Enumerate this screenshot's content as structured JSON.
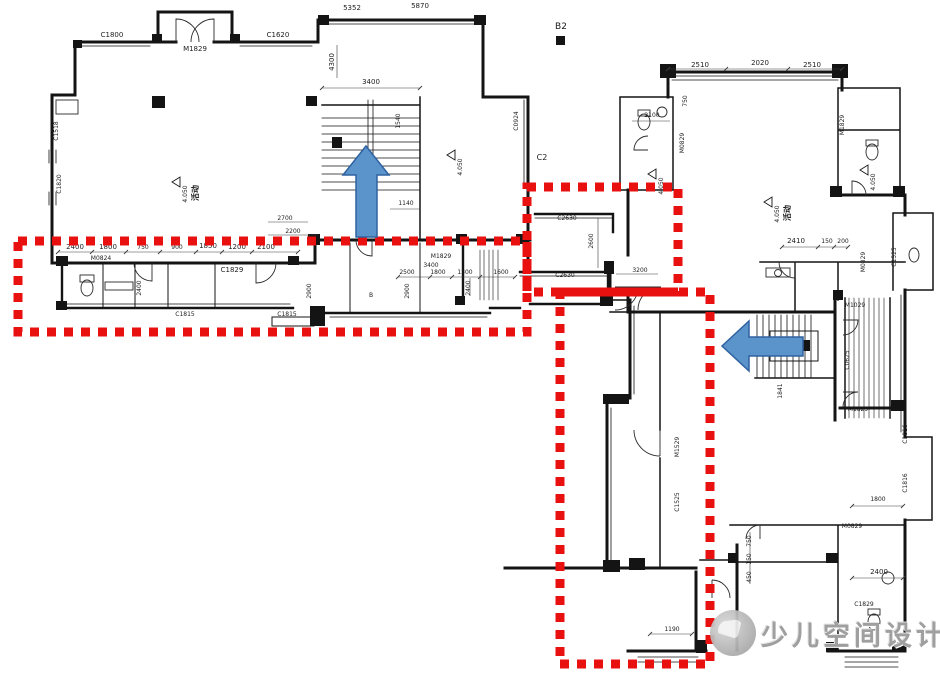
{
  "watermark": {
    "text": "少儿空间设计"
  },
  "colors": {
    "highlight_red": "#e81110",
    "arrow_blue": "#5b93cb",
    "arrow_border": "#2f62a0",
    "wall_black": "#141414",
    "watermark_gray": "#9f9f9f"
  },
  "annotations": {
    "boxes": [
      {
        "name": "highlight-box-left-band",
        "x": 18,
        "y": 241,
        "w": 509,
        "h": 91
      },
      {
        "name": "highlight-box-corridor",
        "x": 527,
        "y": 187,
        "w": 151,
        "h": 105
      },
      {
        "name": "highlight-box-lower-wing",
        "x": 560,
        "y": 292,
        "w": 150,
        "h": 372
      }
    ],
    "arrows": [
      {
        "name": "direction-arrow-up",
        "points": "366,146 343,175 356,175 356,237 377,237 377,175 389,175"
      },
      {
        "name": "direction-arrow-left",
        "points": "722,346 749,321 749,337 803,337 803,356 749,356 749,371"
      }
    ]
  },
  "elevation_markers": [
    {
      "x": 172,
      "y": 182,
      "value": "4.050",
      "room": "活动"
    },
    {
      "x": 447,
      "y": 155,
      "value": "4.050",
      "room": ""
    },
    {
      "x": 648,
      "y": 174,
      "value": "4.050",
      "room": ""
    },
    {
      "x": 764,
      "y": 202,
      "value": "4.050",
      "room": "活动"
    },
    {
      "x": 860,
      "y": 170,
      "value": "4.050",
      "room": ""
    }
  ],
  "plan_labels": [
    {
      "t": "C1800",
      "x": 112,
      "y": 37
    },
    {
      "t": "M1829",
      "x": 195,
      "y": 51
    },
    {
      "t": "C1620",
      "x": 278,
      "y": 37
    },
    {
      "t": "5352",
      "x": 352,
      "y": 10
    },
    {
      "t": "5870",
      "x": 420,
      "y": 8
    },
    {
      "t": "4300",
      "x": 334,
      "y": 62,
      "r": -90
    },
    {
      "t": "3400",
      "x": 371,
      "y": 84
    },
    {
      "t": "1540",
      "x": 400,
      "y": 121,
      "r": -90,
      "s": 6
    },
    {
      "t": "1140",
      "x": 406,
      "y": 205,
      "s": 6
    },
    {
      "t": "2700",
      "x": 285,
      "y": 220,
      "s": 6
    },
    {
      "t": "2200",
      "x": 293,
      "y": 233,
      "s": 6
    },
    {
      "t": "C1518",
      "x": 58,
      "y": 131,
      "r": -90,
      "s": 6
    },
    {
      "t": "C1820",
      "x": 61,
      "y": 184,
      "r": -90,
      "s": 6
    },
    {
      "t": "C0924",
      "x": 518,
      "y": 121,
      "r": -90,
      "s": 6
    },
    {
      "t": "2400",
      "x": 75,
      "y": 249
    },
    {
      "t": "1800",
      "x": 108,
      "y": 249
    },
    {
      "t": "750",
      "x": 143,
      "y": 249,
      "s": 6
    },
    {
      "t": "900",
      "x": 177,
      "y": 249,
      "s": 6
    },
    {
      "t": "1850",
      "x": 208,
      "y": 248
    },
    {
      "t": "1200",
      "x": 237,
      "y": 249
    },
    {
      "t": "2100",
      "x": 266,
      "y": 249
    },
    {
      "t": "M0824",
      "x": 101,
      "y": 260,
      "s": 6
    },
    {
      "t": "C1829",
      "x": 232,
      "y": 272
    },
    {
      "t": "M1829",
      "x": 441,
      "y": 258,
      "s": 6
    },
    {
      "t": "2500",
      "x": 407,
      "y": 274,
      "s": 6
    },
    {
      "t": "1800",
      "x": 438,
      "y": 274,
      "s": 6
    },
    {
      "t": "1300",
      "x": 465,
      "y": 274,
      "s": 6
    },
    {
      "t": "1600",
      "x": 501,
      "y": 274,
      "s": 6
    },
    {
      "t": "2400",
      "x": 141,
      "y": 288,
      "r": -90,
      "s": 6
    },
    {
      "t": "2900",
      "x": 311,
      "y": 291,
      "r": -90,
      "s": 6
    },
    {
      "t": "2900",
      "x": 409,
      "y": 291,
      "r": -90,
      "s": 6
    },
    {
      "t": "2400",
      "x": 470,
      "y": 288,
      "r": -90,
      "s": 6
    },
    {
      "t": "C1815",
      "x": 185,
      "y": 316,
      "s": 6
    },
    {
      "t": "C1815",
      "x": 287,
      "y": 316,
      "s": 6
    },
    {
      "t": "3400",
      "x": 431,
      "y": 267,
      "s": 6
    },
    {
      "t": "B",
      "x": 371,
      "y": 297,
      "s": 6
    },
    {
      "t": "C2630",
      "x": 567,
      "y": 220,
      "s": 6
    },
    {
      "t": "C2630",
      "x": 565,
      "y": 277,
      "s": 6
    },
    {
      "t": "2600",
      "x": 593,
      "y": 241,
      "r": -90,
      "s": 6
    },
    {
      "t": "3200",
      "x": 640,
      "y": 272,
      "s": 6
    },
    {
      "t": "B2",
      "x": 561,
      "y": 29,
      "s": 9
    },
    {
      "t": "C2",
      "x": 542,
      "y": 160,
      "s": 8
    },
    {
      "t": "2510",
      "x": 700,
      "y": 67
    },
    {
      "t": "2020",
      "x": 760,
      "y": 65
    },
    {
      "t": "2510",
      "x": 812,
      "y": 67
    },
    {
      "t": "2100",
      "x": 652,
      "y": 117,
      "s": 6
    },
    {
      "t": "750",
      "x": 687,
      "y": 101,
      "r": -90,
      "s": 6
    },
    {
      "t": "M0829",
      "x": 684,
      "y": 143,
      "r": -90,
      "s": 6
    },
    {
      "t": "M1829",
      "x": 844,
      "y": 125,
      "r": -90,
      "s": 6
    },
    {
      "t": "2410",
      "x": 796,
      "y": 243
    },
    {
      "t": "150",
      "x": 827,
      "y": 243,
      "s": 6
    },
    {
      "t": "200",
      "x": 843,
      "y": 243,
      "s": 6
    },
    {
      "t": "M0829",
      "x": 865,
      "y": 262,
      "r": -90,
      "s": 6
    },
    {
      "t": "C1525",
      "x": 896,
      "y": 257,
      "r": -90,
      "s": 6
    },
    {
      "t": "M1029",
      "x": 855,
      "y": 307,
      "s": 6
    },
    {
      "t": "C0625",
      "x": 849,
      "y": 360,
      "r": -90,
      "s": 6
    },
    {
      "t": "1841",
      "x": 782,
      "y": 391,
      "r": -90,
      "s": 6
    },
    {
      "t": "M1829",
      "x": 858,
      "y": 411,
      "s": 6
    },
    {
      "t": "C1816",
      "x": 907,
      "y": 434,
      "r": -90,
      "s": 6
    },
    {
      "t": "C1816",
      "x": 907,
      "y": 483,
      "r": -90,
      "s": 6
    },
    {
      "t": "1800",
      "x": 878,
      "y": 501,
      "s": 6
    },
    {
      "t": "M0829",
      "x": 852,
      "y": 528,
      "s": 6
    },
    {
      "t": "2400",
      "x": 879,
      "y": 574
    },
    {
      "t": "C1829",
      "x": 864,
      "y": 606,
      "s": 6
    },
    {
      "t": "750",
      "x": 751,
      "y": 541,
      "r": -90,
      "s": 6
    },
    {
      "t": "150",
      "x": 751,
      "y": 559,
      "r": -90,
      "s": 6
    },
    {
      "t": "450",
      "x": 751,
      "y": 577,
      "r": -90,
      "s": 6
    },
    {
      "t": "M1529",
      "x": 679,
      "y": 447,
      "r": -90,
      "s": 6
    },
    {
      "t": "C1525",
      "x": 679,
      "y": 502,
      "r": -90,
      "s": 6
    },
    {
      "t": "1190",
      "x": 672,
      "y": 631,
      "s": 6
    }
  ]
}
